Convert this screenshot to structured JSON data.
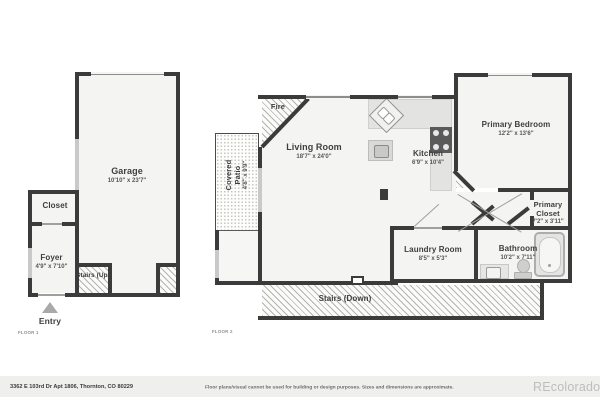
{
  "floor1": {
    "label": "FLOOR 1",
    "rooms": {
      "garage": {
        "name": "Garage",
        "dims": "10'10\" x 23'7\""
      },
      "closet": {
        "name": "Closet"
      },
      "foyer": {
        "name": "Foyer",
        "dims": "4'9\" x 7'10\""
      },
      "stairs_up": {
        "name": "Stairs (Up)"
      },
      "entry": {
        "name": "Entry"
      }
    }
  },
  "floor2": {
    "label": "FLOOR 2",
    "rooms": {
      "covered_patio": {
        "name": "Covered Patio",
        "dims": "4'8\" x 9'9\""
      },
      "fire": {
        "name": "Fire"
      },
      "living_room": {
        "name": "Living Room",
        "dims": "18'7\" x 24'0\""
      },
      "kitchen": {
        "name": "Kitchen",
        "dims": "6'9\" x 10'4\""
      },
      "primary_bedroom": {
        "name": "Primary Bedroom",
        "dims": "12'2\" x 13'6\""
      },
      "primary_closet": {
        "name": "Primary Closet",
        "dims": "7'2\" x 3'11\""
      },
      "bathroom": {
        "name": "Bathroom",
        "dims": "10'2\" x 7'11\""
      },
      "laundry_room": {
        "name": "Laundry Room",
        "dims": "8'5\" x 5'3\""
      },
      "stairs_down": {
        "name": "Stairs (Down)"
      }
    }
  },
  "footer": {
    "address": "3362 E 103rd Dr Apt 1806, Thornton, CO 80229",
    "disclaimer": "Floor plans/visual cannot be used for building or design purposes. Sizes and dimensions are approximate.",
    "brand": "REcolorado"
  },
  "colors": {
    "wall": "#3b3b3b",
    "floor": "#f4f4f3",
    "door_window": "#c9c9c9",
    "footer_bar": "#efefee",
    "brand_gray": "#bdbdbd"
  }
}
